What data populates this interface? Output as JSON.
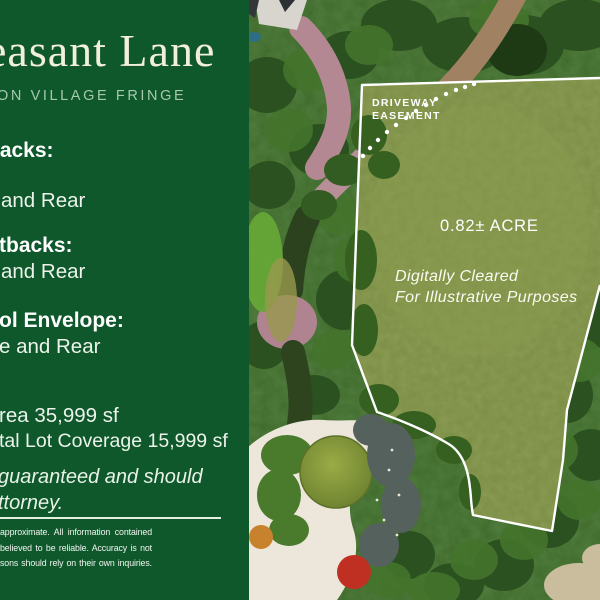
{
  "panel": {
    "title": "easant Lane",
    "subtitle": "ON VILLAGE FRINGE",
    "sections": [
      {
        "heading": "backs:",
        "body": "and Rear"
      },
      {
        "heading": "tbacks:",
        "body": "and Rear"
      },
      {
        "heading": "ol Envelope:",
        "body": "e and Rear"
      }
    ],
    "stats": {
      "lot_area": "rea 35,999 sf",
      "lot_coverage": "tal Lot Coverage 15,999 sf"
    },
    "note_lines": {
      "line1": "guaranteed and should",
      "line2": "ttorney."
    },
    "disclaimer_lines": {
      "line1": "approximate.  All information contained",
      "line2": "believed to be reliable.  Accuracy is not",
      "line3": "sons should rely on their own inquiries."
    },
    "colors": {
      "background_green": "#0E582C",
      "title_ivory": "#F3EFDE",
      "subtitle_green": "#A6C9AE",
      "body_text": "#EDF3EA"
    }
  },
  "map": {
    "labels": {
      "easement_line1": "DRIVEWAY",
      "easement_line2": "EASEMENT",
      "acreage": "0.82± ACRE",
      "cleared_line1": "Digitally Cleared",
      "cleared_line2": "For Illustrative Purposes"
    },
    "colors": {
      "lot_outline": "#FFFFFF",
      "lawn_green": "#7B8E44",
      "tree_green": "#3F6A2A",
      "driveway_pink": "#B88E98",
      "gravel_cream": "#ECE7DA"
    }
  }
}
